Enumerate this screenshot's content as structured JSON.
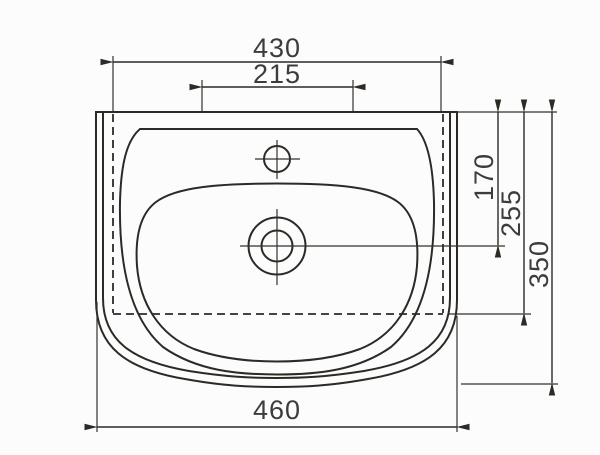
{
  "meta": {
    "title": "Washbasin dimensional drawing (top view)",
    "background_color": "#fcfcfc",
    "line_color": "#2d2a26",
    "text_color": "#3c3c3c"
  },
  "drawing": {
    "view": "top",
    "subject": "washbasin",
    "dimensions": {
      "top_width": "430",
      "tap_spacing": "215",
      "drain_center_depth": "170",
      "hidden_edge_depth": "255",
      "total_depth": "350",
      "bottom_width": "460"
    }
  }
}
